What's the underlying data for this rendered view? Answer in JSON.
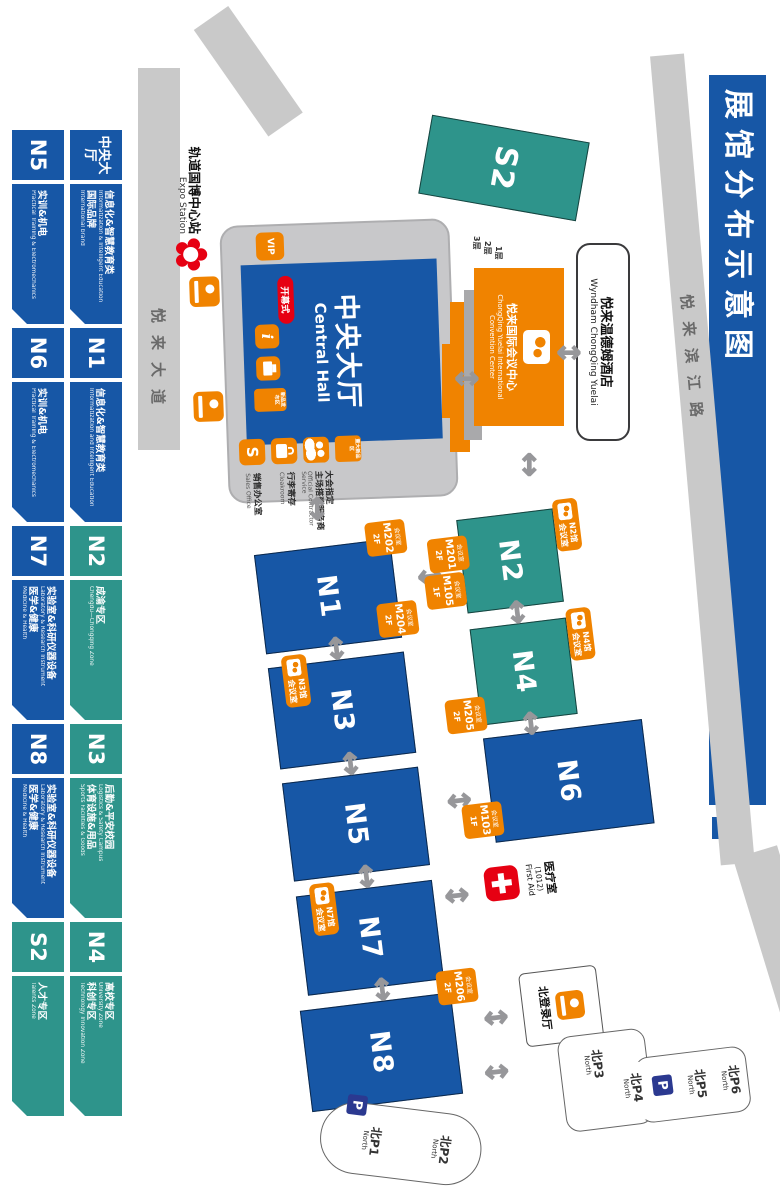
{
  "title": "展馆分布示意图",
  "roads": {
    "riverside": "悦来滨江路",
    "avenue": "悦来大道"
  },
  "station": {
    "cn": "轨道国博中心站",
    "en": "Expo Station"
  },
  "central_hall": {
    "cn": "中央大厅",
    "en": "Central Hall",
    "vip": "VIP",
    "opening": "开幕式",
    "release_badge": "新品发布区",
    "major_badge": "重大新品区",
    "info": "i",
    "sales_letter": "S",
    "services": [
      {
        "cn": "大会指定",
        "cn2": "主场搭建服务商",
        "en": "Official Contractor Service"
      },
      {
        "cn": "行李寄存",
        "en": "Cloakroom"
      },
      {
        "cn": "销售办公室",
        "en": "Sales Office"
      }
    ]
  },
  "convention_center": {
    "cn": "悦来国际会议中心",
    "en1": "ChongQing Yuelai International",
    "en2": "Convention Center",
    "floors": [
      "1层",
      "2层",
      "3层"
    ]
  },
  "hotel": {
    "cn": "悦来温德姆酒店",
    "en": "Wyndham ChongQing Yuelai"
  },
  "halls": [
    {
      "name": "N1"
    },
    {
      "name": "N2"
    },
    {
      "name": "N3"
    },
    {
      "name": "N4"
    },
    {
      "name": "N5"
    },
    {
      "name": "N6"
    },
    {
      "name": "N7"
    },
    {
      "name": "N8"
    },
    {
      "name": "S2"
    }
  ],
  "hall_meeting_badges": [
    {
      "hall": "N2馆",
      "label": "会议室"
    },
    {
      "hall": "N4馆",
      "label": "会议室"
    },
    {
      "hall": "N3馆",
      "label": "会议室"
    },
    {
      "hall": "N7馆",
      "label": "会议室"
    }
  ],
  "meeting_rooms": [
    {
      "label": "会议室",
      "room": "M202",
      "floor": "2F"
    },
    {
      "label": "会议室",
      "room": "M204",
      "floor": "2F"
    },
    {
      "label": "会议室",
      "room": "M201",
      "floor": "2F"
    },
    {
      "label": "会议室",
      "room": "M105",
      "floor": "1F"
    },
    {
      "label": "会议室",
      "room": "M205",
      "floor": "2F"
    },
    {
      "label": "会议室",
      "room": "M103",
      "floor": "1F"
    },
    {
      "label": "会议室",
      "room": "M206",
      "floor": "2F"
    }
  ],
  "first_aid": {
    "cn": "医疗室",
    "num": "(1012)",
    "en": "First Aid"
  },
  "registration": {
    "label": "北登录厅"
  },
  "parking": {
    "p_icon": "P",
    "lot_north_upper": [
      {
        "p": "北P6",
        "en": "North"
      },
      {
        "p": "北P5",
        "en": "North"
      },
      {
        "p": "北P4",
        "en": "North"
      },
      {
        "p": "北P3",
        "en": "North"
      }
    ],
    "lot_north_lower": [
      {
        "p": "北P2",
        "en": "North"
      },
      {
        "p": "北P1",
        "en": "North"
      }
    ]
  },
  "legend": {
    "row1": [
      {
        "header": "中央大厅",
        "lines": [
          {
            "cn": "信息化&智慧教育类",
            "en": "Informatization & Intelligent Education"
          },
          {
            "cn": "国际品牌",
            "en": "International brand"
          }
        ]
      },
      {
        "header": "N1",
        "lines": [
          {
            "cn": "信息化&智慧教育类",
            "en": "Informatization and Intelligent Education"
          }
        ]
      },
      {
        "header": "N2",
        "lines": [
          {
            "cn": "成渝专区",
            "en": "Chengdu—Chongqing Zone"
          }
        ]
      },
      {
        "header": "N3",
        "lines": [
          {
            "cn": "后勤&平安校园",
            "en": "Logistics & Safety Campus"
          },
          {
            "cn": "体育设施&用品",
            "en": "Sports Facilities & Goods"
          }
        ]
      },
      {
        "header": "N4",
        "lines": [
          {
            "cn": "高校专区",
            "en": "University Zone"
          },
          {
            "cn": "科创专区",
            "en": "Technology Innovation Zone"
          }
        ]
      }
    ],
    "row2": [
      {
        "header": "N5",
        "lines": [
          {
            "cn": "实训&机电",
            "en": "Practical Training & Electromechanics"
          }
        ]
      },
      {
        "header": "N6",
        "lines": [
          {
            "cn": "实训&机电",
            "en": "Practical Training & Electromechanics"
          }
        ]
      },
      {
        "header": "N7",
        "lines": [
          {
            "cn": "实验室&科研仪器设备",
            "en": "Laboratory & Research Instrument"
          },
          {
            "cn": "医学&健康",
            "en": "Medicine & Health"
          }
        ]
      },
      {
        "header": "N8",
        "lines": [
          {
            "cn": "实验室&科研仪器设备",
            "en": "Laboratory & Research Instrument"
          },
          {
            "cn": "医学&健康",
            "en": "Medicine & Health"
          }
        ]
      },
      {
        "header": "S2",
        "lines": [
          {
            "cn": "人才专区",
            "en": "Talents Zone"
          }
        ]
      }
    ]
  }
}
